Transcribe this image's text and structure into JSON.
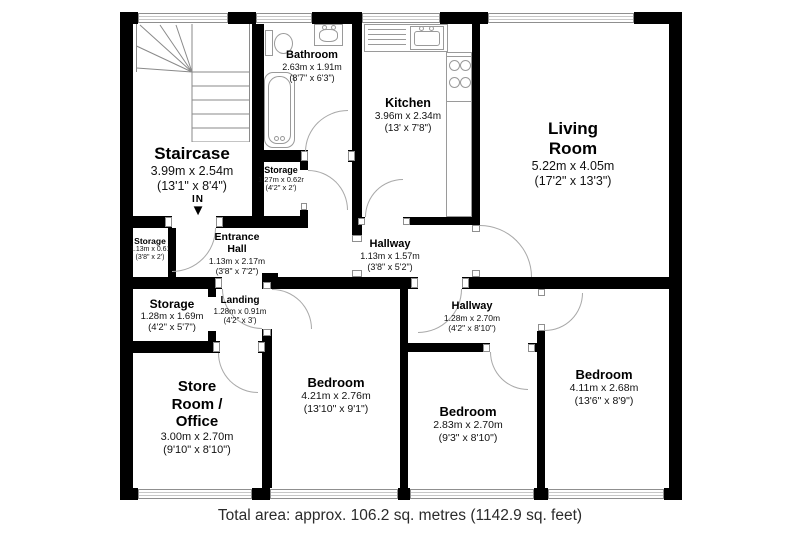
{
  "rooms": {
    "staircase": {
      "name": "Staircase",
      "metric": "3.99m x 2.54m",
      "imperial": "(13'1\" x 8'4\")"
    },
    "bathroom": {
      "name": "Bathroom",
      "metric": "2.63m x 1.91m",
      "imperial": "(8'7\" x 6'3\")"
    },
    "kitchen": {
      "name": "Kitchen",
      "metric": "3.96m x 2.34m",
      "imperial": "(13' x 7'8\")"
    },
    "living_room": {
      "name": "Living",
      "name2": "Room",
      "metric": "5.22m x 4.05m",
      "imperial": "(17'2\" x 13'3\")"
    },
    "storage_bathroom": {
      "name": "Storage",
      "metric": "1.27m x 0.62m",
      "imperial": "(4'2\" x 2')"
    },
    "storage_hall": {
      "name": "Storage",
      "metric": "1.13m x 0.61m",
      "imperial": "(3'8\" x 2')"
    },
    "entrance_hall": {
      "name": "Entrance",
      "name2": "Hall",
      "metric": "1.13m x 2.17m",
      "imperial": "(3'8\" x 7'2\")"
    },
    "hallway_upper": {
      "name": "Hallway",
      "metric": "1.13m x 1.57m",
      "imperial": "(3'8\" x 5'2\")"
    },
    "storage_landing": {
      "name": "Storage",
      "metric": "1.28m x 1.69m",
      "imperial": "(4'2\" x 5'7\")"
    },
    "landing": {
      "name": "Landing",
      "metric": "1.28m x 0.91m",
      "imperial": "(4'2\" x 3')"
    },
    "store_room_office": {
      "name": "Store",
      "name2": "Room /",
      "name3": "Office",
      "metric": "3.00m x 2.70m",
      "imperial": "(9'10\" x 8'10\")"
    },
    "hallway_lower": {
      "name": "Hallway",
      "metric": "1.28m x 2.70m",
      "imperial": "(4'2\" x 8'10\")"
    },
    "bedroom_left": {
      "name": "Bedroom",
      "metric": "4.21m x 2.76m",
      "imperial": "(13'10\" x 9'1\")"
    },
    "bedroom_middle": {
      "name": "Bedroom",
      "metric": "2.83m x 2.70m",
      "imperial": "(9'3\" x 8'10\")"
    },
    "bedroom_right": {
      "name": "Bedroom",
      "metric": "4.11m x 2.68m",
      "imperial": "(13'6\" x 8'9\")"
    }
  },
  "entry": {
    "label": "IN",
    "arrow": "▼"
  },
  "footer": {
    "total_area": "Total area: approx. 106.2 sq. metres (1142.9 sq. feet)"
  },
  "colors": {
    "wall": "#000000",
    "thin_line": "#9a9a9a",
    "text": "#111111",
    "background": "#ffffff"
  }
}
